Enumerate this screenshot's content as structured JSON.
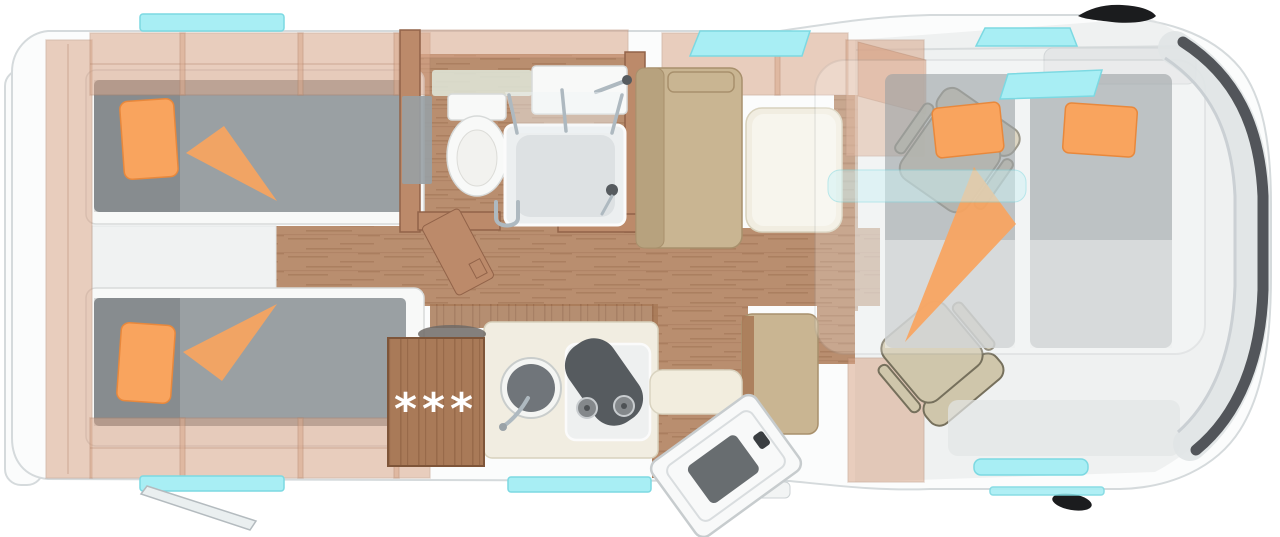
{
  "colors": {
    "shell": "#fbfcfc",
    "shell_edge": "#d5dadc",
    "wall": "#d9a78b",
    "wall_edge": "#b08267",
    "wood_wall": "#bc8a6a",
    "wood_wall_edge": "#926349",
    "wood": "#b98e6f",
    "wood_streak": "#9e6f52",
    "wood_cab": "#a97a58",
    "wood_cab_streak": "#8a5c3e",
    "mattress": "#9aa0a3",
    "orange": "#f9a45e",
    "orange_edge": "#e8883c",
    "furn_white": "#f8f9f8",
    "furn_white_edge": "#d7dad9",
    "cream": "#f1ede1",
    "cream_edge": "#d8d2bd",
    "bench": "#c9b592",
    "bench_edge": "#a8906c",
    "bench_dark": "#b7a27e",
    "seat": "#cfc6ab",
    "seat_edge": "#76705c",
    "glass": "#a8eef4",
    "glass_edge": "#7cd9e2",
    "glass_pale": "#cdf2f5",
    "chrome": "#aeb9c0",
    "dark": "#565b5f",
    "black": "#1b1c1e",
    "cab_gray": "#e3e5e6"
  },
  "kitchen": {
    "freezer_stars": "***"
  },
  "floorplan": {
    "view": "top-down",
    "areas": [
      "twin-bedroom",
      "bathroom",
      "shower",
      "kitchen",
      "dinette",
      "entrance",
      "drop-down-bed",
      "cab"
    ]
  }
}
